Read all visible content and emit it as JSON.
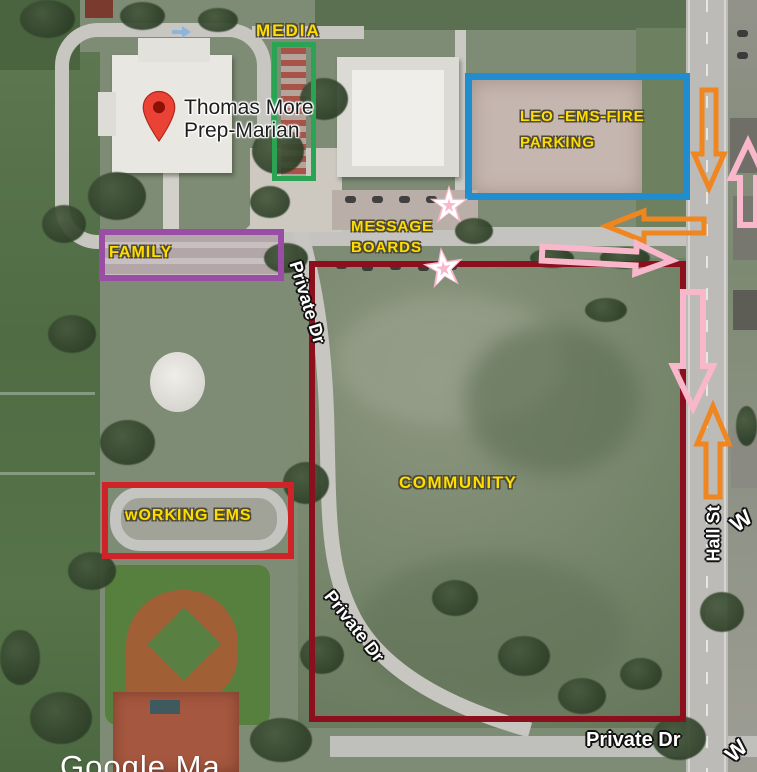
{
  "watermark": "Google Ma",
  "pin": {
    "title_line1": "Thomas More",
    "title_line2": "Prep-Marian"
  },
  "zones": {
    "media": {
      "label": "MEDIA",
      "color": "#2aa352"
    },
    "leo": {
      "line1": "LEO -EMS-FIRE",
      "line2": "PARKING",
      "color": "#1f8dd0"
    },
    "family": {
      "label": "FAMILY",
      "color": "#9a4da4"
    },
    "message_boards": {
      "line1": "MESSAGE",
      "line2": "BOARDS"
    },
    "community": {
      "label": "COMMUNITY",
      "color": "#8c0f1d"
    },
    "working_ems": {
      "label": "wORKING EMS",
      "color": "#ce2427"
    }
  },
  "roads": {
    "private_dr_upper": "Private Dr",
    "private_dr_lower": "Private Dr",
    "private_dr_bottom": "Private Dr",
    "hall_st": "Hall St",
    "w_mid": "W",
    "w_bottom": "W"
  },
  "markers": {
    "label_yellow": "#ffdd00",
    "orange_arrow_color": "#f0861f",
    "pink_arrow_color": "#f8b7ca",
    "star_color": "#f8b7ca"
  }
}
